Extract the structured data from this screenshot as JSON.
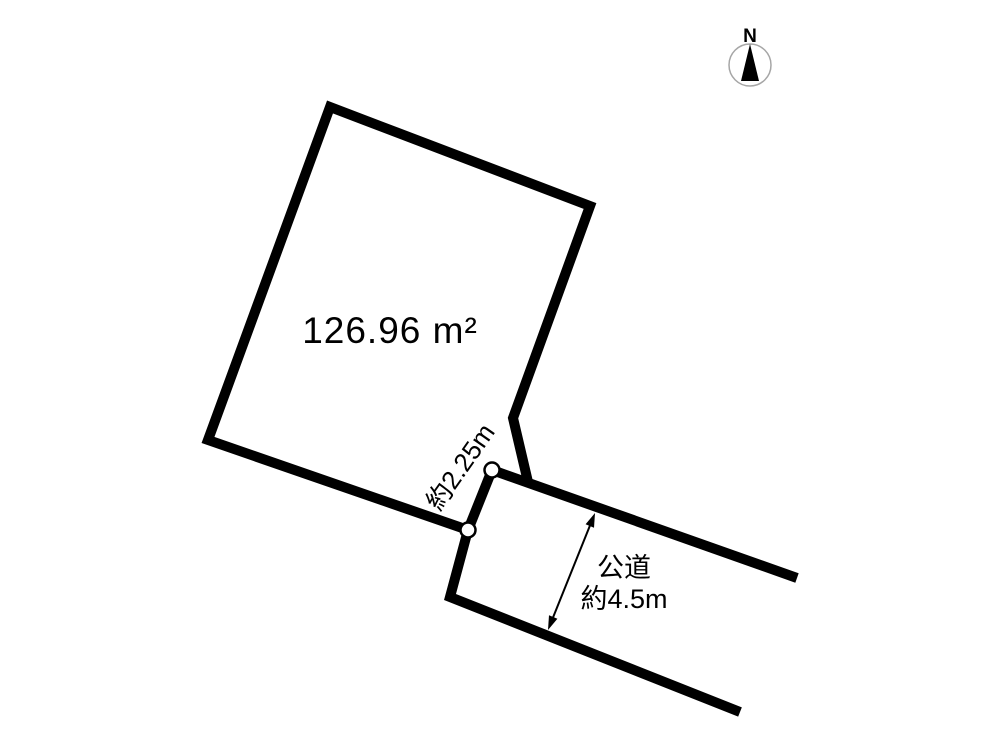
{
  "compass": {
    "label": "N",
    "icon": "north-arrow-icon",
    "ring_color": "#a6a6a6",
    "arrow_color": "#000000"
  },
  "parcel": {
    "area_label": "126.96 m²",
    "frontage_label": "約2.25m"
  },
  "road": {
    "name": "公道",
    "width_label": "約4.5m"
  },
  "colors": {
    "background": "#ffffff",
    "line": "#000000",
    "boundary_marker_fill": "#ffffff"
  }
}
